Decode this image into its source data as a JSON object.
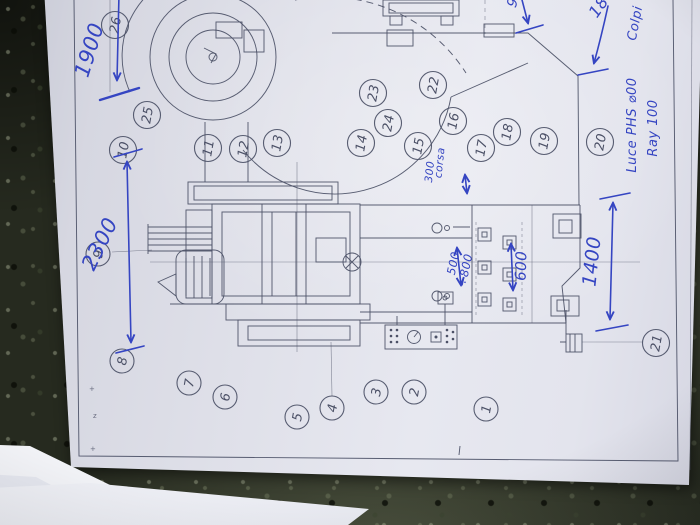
{
  "photo": {
    "stone_color": "#262a1f",
    "paper_color": "#dcdde7",
    "ink_color": "#3545c2",
    "print_color": "#4b5066"
  },
  "drawing": {
    "balloons": [
      {
        "n": "26",
        "x": 115,
        "y": 25
      },
      {
        "n": "25",
        "x": 147,
        "y": 115
      },
      {
        "n": "10",
        "x": 123,
        "y": 150
      },
      {
        "n": "11",
        "x": 208,
        "y": 148
      },
      {
        "n": "12",
        "x": 243,
        "y": 149
      },
      {
        "n": "13",
        "x": 277,
        "y": 143
      },
      {
        "n": "23",
        "x": 373,
        "y": 93
      },
      {
        "n": "22",
        "x": 433,
        "y": 85
      },
      {
        "n": "24",
        "x": 388,
        "y": 123
      },
      {
        "n": "16",
        "x": 453,
        "y": 121
      },
      {
        "n": "14",
        "x": 361,
        "y": 143
      },
      {
        "n": "15",
        "x": 418,
        "y": 146
      },
      {
        "n": "17",
        "x": 481,
        "y": 148
      },
      {
        "n": "18",
        "x": 507,
        "y": 132
      },
      {
        "n": "19",
        "x": 544,
        "y": 141
      },
      {
        "n": "20",
        "x": 600,
        "y": 142
      },
      {
        "n": "9",
        "x": 98,
        "y": 254
      },
      {
        "n": "8",
        "x": 122,
        "y": 361
      },
      {
        "n": "7",
        "x": 189,
        "y": 383
      },
      {
        "n": "6",
        "x": 225,
        "y": 397
      },
      {
        "n": "5",
        "x": 297,
        "y": 417
      },
      {
        "n": "4",
        "x": 332,
        "y": 408
      },
      {
        "n": "3",
        "x": 376,
        "y": 392
      },
      {
        "n": "2",
        "x": 414,
        "y": 392
      },
      {
        "n": "1",
        "x": 486,
        "y": 409
      },
      {
        "n": "21",
        "x": 656,
        "y": 343
      }
    ],
    "hand_annotations": [
      {
        "text": "1900",
        "x": 96,
        "y": 52,
        "rot": -73,
        "size": 21
      },
      {
        "text": "2300",
        "x": 106,
        "y": 247,
        "rot": -64,
        "size": 21
      },
      {
        "text": "1400",
        "x": 598,
        "y": 262,
        "rot": -84,
        "size": 19
      },
      {
        "text": "600",
        "x": 526,
        "y": 266,
        "rot": -88,
        "size": 15
      },
      {
        "text": "500",
        "x": 457,
        "y": 264,
        "rot": -78,
        "size": 11.5
      },
      {
        "text": "÷800",
        "x": 469,
        "y": 271,
        "rot": -78,
        "size": 11.5
      },
      {
        "text": "corsa",
        "x": 443,
        "y": 163,
        "rot": -84,
        "size": 10.5
      },
      {
        "text": "300",
        "x": 433,
        "y": 172,
        "rot": -84,
        "size": 10.5
      },
      {
        "text": "Colpi",
        "x": 639,
        "y": 24,
        "rot": -79,
        "size": 13
      },
      {
        "text": "18",
        "x": 603,
        "y": 10,
        "rot": -55,
        "size": 16
      },
      {
        "text": "9",
        "x": 517,
        "y": 4,
        "rot": -70,
        "size": 14
      },
      {
        "text": "Luce PHS ⌀00",
        "x": 636,
        "y": 125,
        "rot": -90,
        "size": 13
      },
      {
        "text": "Ray 100",
        "x": 657,
        "y": 128,
        "rot": -90,
        "size": 13
      }
    ],
    "tiny_marks": [
      {
        "t": "+",
        "x": 89,
        "y": 391
      },
      {
        "t": "z",
        "x": 93,
        "y": 418
      },
      {
        "t": "+",
        "x": 90,
        "y": 451
      }
    ]
  }
}
